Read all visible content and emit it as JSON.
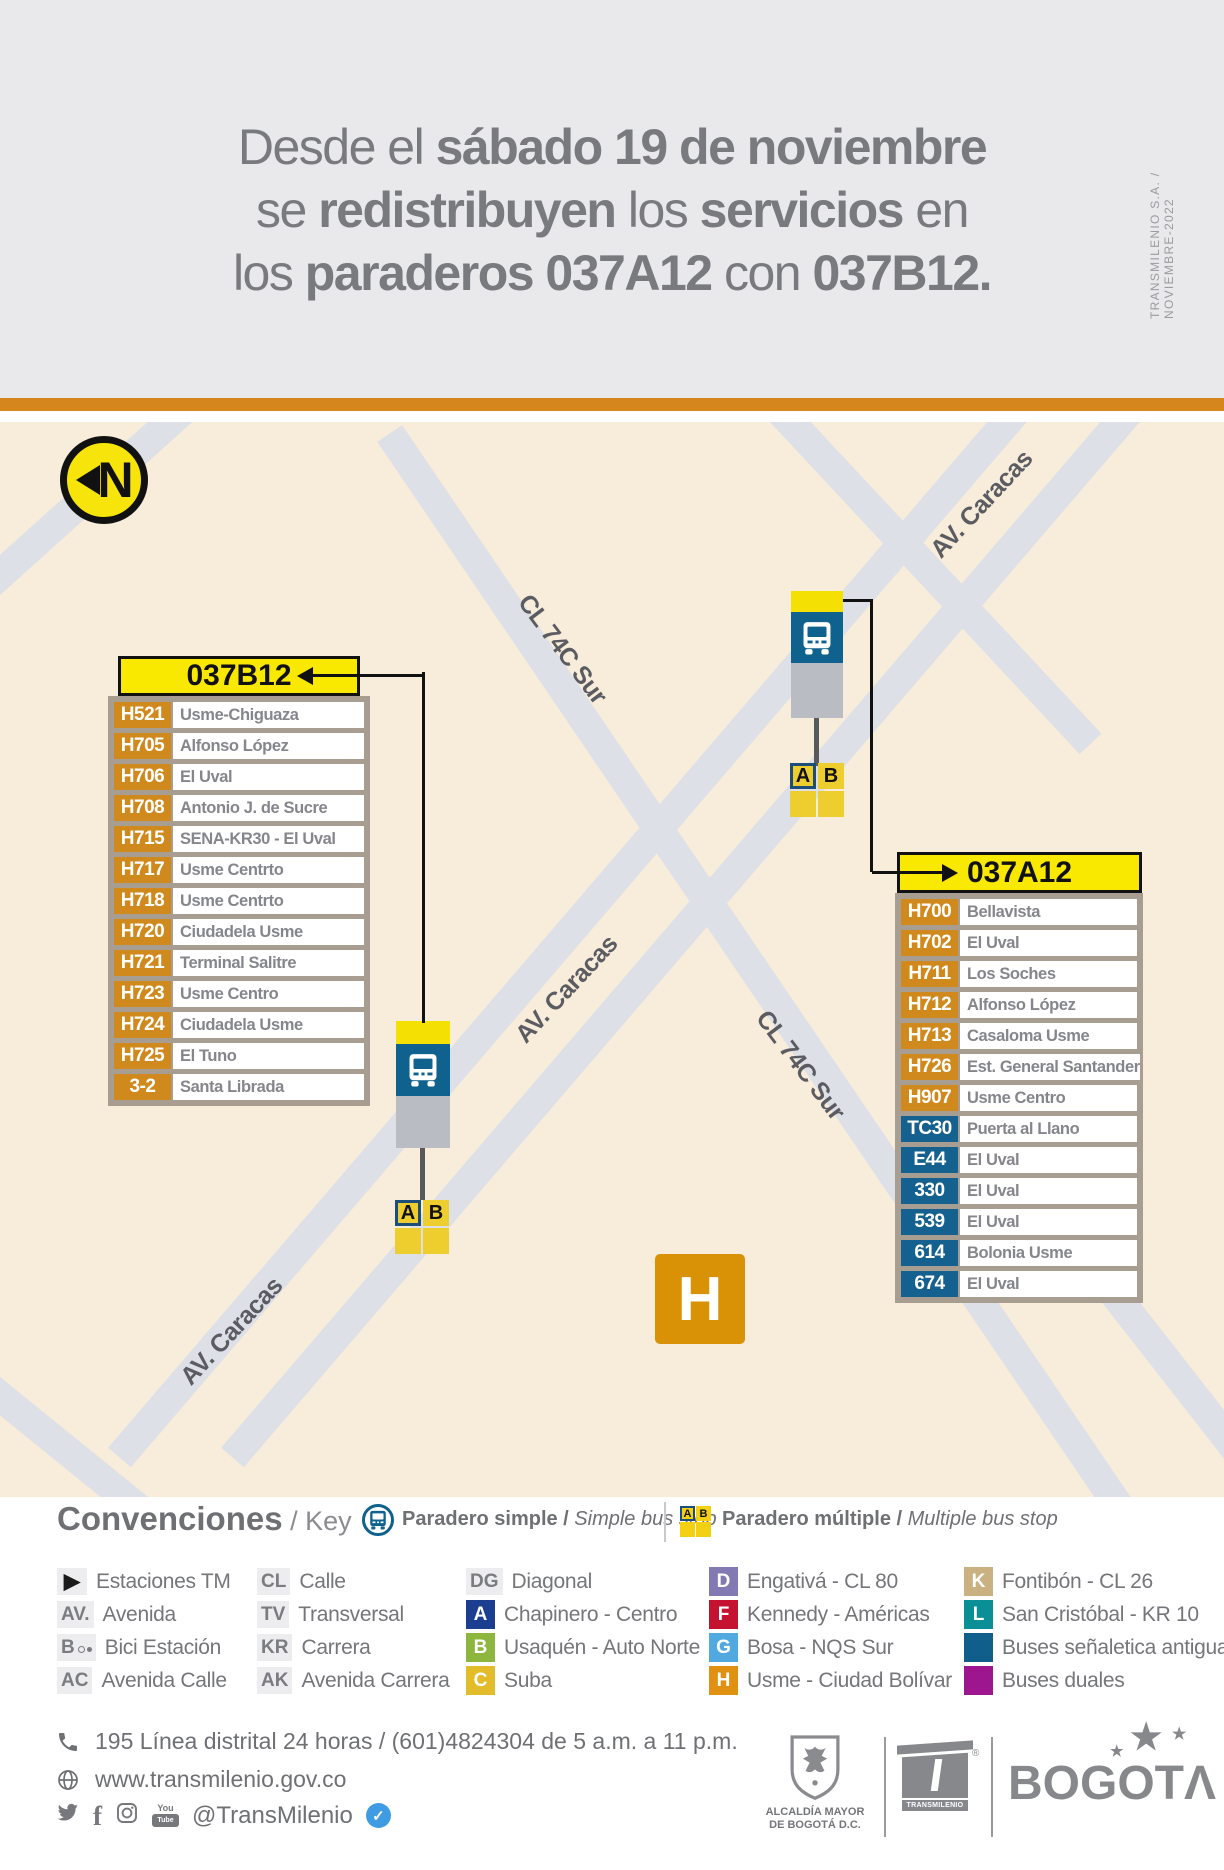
{
  "side_note": "TRANSMILENIO S.A. / NOVIEMBRE-2022",
  "header": {
    "l1a": "Desde el ",
    "l1b": "sábado 19 de noviembre",
    "l2a": "se ",
    "l2b": "redistribuyen",
    "l2c": " los ",
    "l2d": "servicios",
    "l2e": " en",
    "l3a": "los ",
    "l3b": "paraderos 037A12",
    "l3c": " con ",
    "l3d": "037B12."
  },
  "map": {
    "north_label": "N",
    "street_label_cl74c": "CL 74C Sur",
    "street_label_caracas": "AV. Caracas",
    "zone_label": "H",
    "stop_letter_a": "A",
    "stop_letter_b": "B"
  },
  "stop_tables": {
    "b": {
      "code": "037B12",
      "rows": [
        {
          "code": "H521",
          "name": "Usme-Chiguaza",
          "color": "c-orange"
        },
        {
          "code": "H705",
          "name": "Alfonso López",
          "color": "c-orange"
        },
        {
          "code": "H706",
          "name": "El Uval",
          "color": "c-orange"
        },
        {
          "code": "H708",
          "name": "Antonio J. de Sucre",
          "color": "c-orange"
        },
        {
          "code": "H715",
          "name": "SENA-KR30 - El Uval",
          "color": "c-orange"
        },
        {
          "code": "H717",
          "name": "Usme Centrto",
          "color": "c-orange"
        },
        {
          "code": "H718",
          "name": "Usme Centrto",
          "color": "c-orange"
        },
        {
          "code": "H720",
          "name": "Ciudadela Usme",
          "color": "c-orange"
        },
        {
          "code": "H721",
          "name": "Terminal Salitre",
          "color": "c-orange"
        },
        {
          "code": "H723",
          "name": "Usme Centro",
          "color": "c-orange"
        },
        {
          "code": "H724",
          "name": "Ciudadela Usme",
          "color": "c-orange"
        },
        {
          "code": "H725",
          "name": "El Tuno",
          "color": "c-orange"
        },
        {
          "code": "3-2",
          "name": "Santa Librada",
          "color": "c-orange"
        }
      ]
    },
    "a": {
      "code": "037A12",
      "rows": [
        {
          "code": "H700",
          "name": "Bellavista",
          "color": "c-orange"
        },
        {
          "code": "H702",
          "name": "El Uval",
          "color": "c-orange"
        },
        {
          "code": "H711",
          "name": "Los Soches",
          "color": "c-orange"
        },
        {
          "code": "H712",
          "name": "Alfonso López",
          "color": "c-orange"
        },
        {
          "code": "H713",
          "name": "Casaloma Usme",
          "color": "c-orange"
        },
        {
          "code": "H726",
          "name": "Est. General Santander",
          "color": "c-orange"
        },
        {
          "code": "H907",
          "name": "Usme Centro",
          "color": "c-orange"
        },
        {
          "code": "TC30",
          "name": "Puerta al Llano",
          "color": "c-blue"
        },
        {
          "code": "E44",
          "name": "El Uval",
          "color": "c-blue"
        },
        {
          "code": "330",
          "name": "El Uval",
          "color": "c-blue"
        },
        {
          "code": "539",
          "name": "El Uval",
          "color": "c-blue"
        },
        {
          "code": "614",
          "name": "Bolonia Usme",
          "color": "c-blue"
        },
        {
          "code": "674",
          "name": "El Uval",
          "color": "c-blue"
        }
      ]
    }
  },
  "legend": {
    "title": "Convenciones",
    "title_key": " / Key",
    "simple_label": "Paradero simple / ",
    "simple_label_italic": "Simple bus stop",
    "multiple_label": "Paradero múltiple / ",
    "multiple_label_italic": "Multiple bus stop",
    "columns": {
      "c1": [
        {
          "chip": "▶",
          "cls": "chip est",
          "label": "Estaciones TM"
        },
        {
          "chip": "AV.",
          "cls": "chip",
          "label": "Avenida"
        },
        {
          "chip": "B",
          "cls": "chip bici",
          "label": "Bici Estación"
        },
        {
          "chip": "AC",
          "cls": "chip",
          "label": "Avenida Calle"
        }
      ],
      "c2": [
        {
          "chip": "CL",
          "cls": "chip",
          "label": "Calle"
        },
        {
          "chip": "TV",
          "cls": "chip",
          "label": "Transversal"
        },
        {
          "chip": "KR",
          "cls": "chip",
          "label": "Carrera"
        },
        {
          "chip": "AK",
          "cls": "chip",
          "label": "Avenida Carrera"
        }
      ],
      "c3": [
        {
          "chip": "DG",
          "cls": "chip",
          "label": "Diagonal"
        },
        {
          "chip": "A",
          "cls": "badge b-a",
          "label": "Chapinero - Centro"
        },
        {
          "chip": "B",
          "cls": "badge b-b",
          "label": "Usaquén - Auto Norte"
        },
        {
          "chip": "C",
          "cls": "badge b-c",
          "label": "Suba"
        }
      ],
      "c4": [
        {
          "chip": "D",
          "cls": "badge b-d",
          "label": "Engativá - CL 80"
        },
        {
          "chip": "F",
          "cls": "badge b-f",
          "label": "Kennedy - Américas"
        },
        {
          "chip": "G",
          "cls": "badge b-g",
          "label": "Bosa - NQS Sur"
        },
        {
          "chip": "H",
          "cls": "badge b-h",
          "label": "Usme - Ciudad Bolívar"
        }
      ],
      "c5": [
        {
          "chip": "K",
          "cls": "badge b-k",
          "label": "Fontibón - CL 26"
        },
        {
          "chip": "L",
          "cls": "badge b-l",
          "label": "San Cristóbal - KR 10"
        },
        {
          "chip": "",
          "cls": "badge sw-antigua",
          "label": "Buses señaletica antigua"
        },
        {
          "chip": "",
          "cls": "badge sw-duales",
          "label": "Buses duales"
        }
      ]
    }
  },
  "footer": {
    "phone": "195 Línea distrital 24 horas / (601)4824304 de 5 a.m. a 11 p.m.",
    "website": "www.transmilenio.gov.co",
    "social_handle": "@TransMilenio",
    "verified_check": "✓",
    "alcaldia_line1": "ALCALDÍA MAYOR",
    "alcaldia_line2": "DE BOGOTÁ D.C.",
    "transmilenio_logo": "TRANSMILENIO",
    "registered_mark": "®",
    "bogota_prefix": "BOGOT",
    "bogota_last": "Λ",
    "star": "★"
  },
  "colors": {
    "accent_orange_bar": "#d5871e",
    "map_beige": "#f8ecda",
    "stop_yellow": "#f8e100",
    "stop_blue": "#0f618e",
    "badge_orange": "#d0891c",
    "badge_blue": "#14618f",
    "zone_orange": "#d99206",
    "verified_blue": "#3f9ce3"
  }
}
